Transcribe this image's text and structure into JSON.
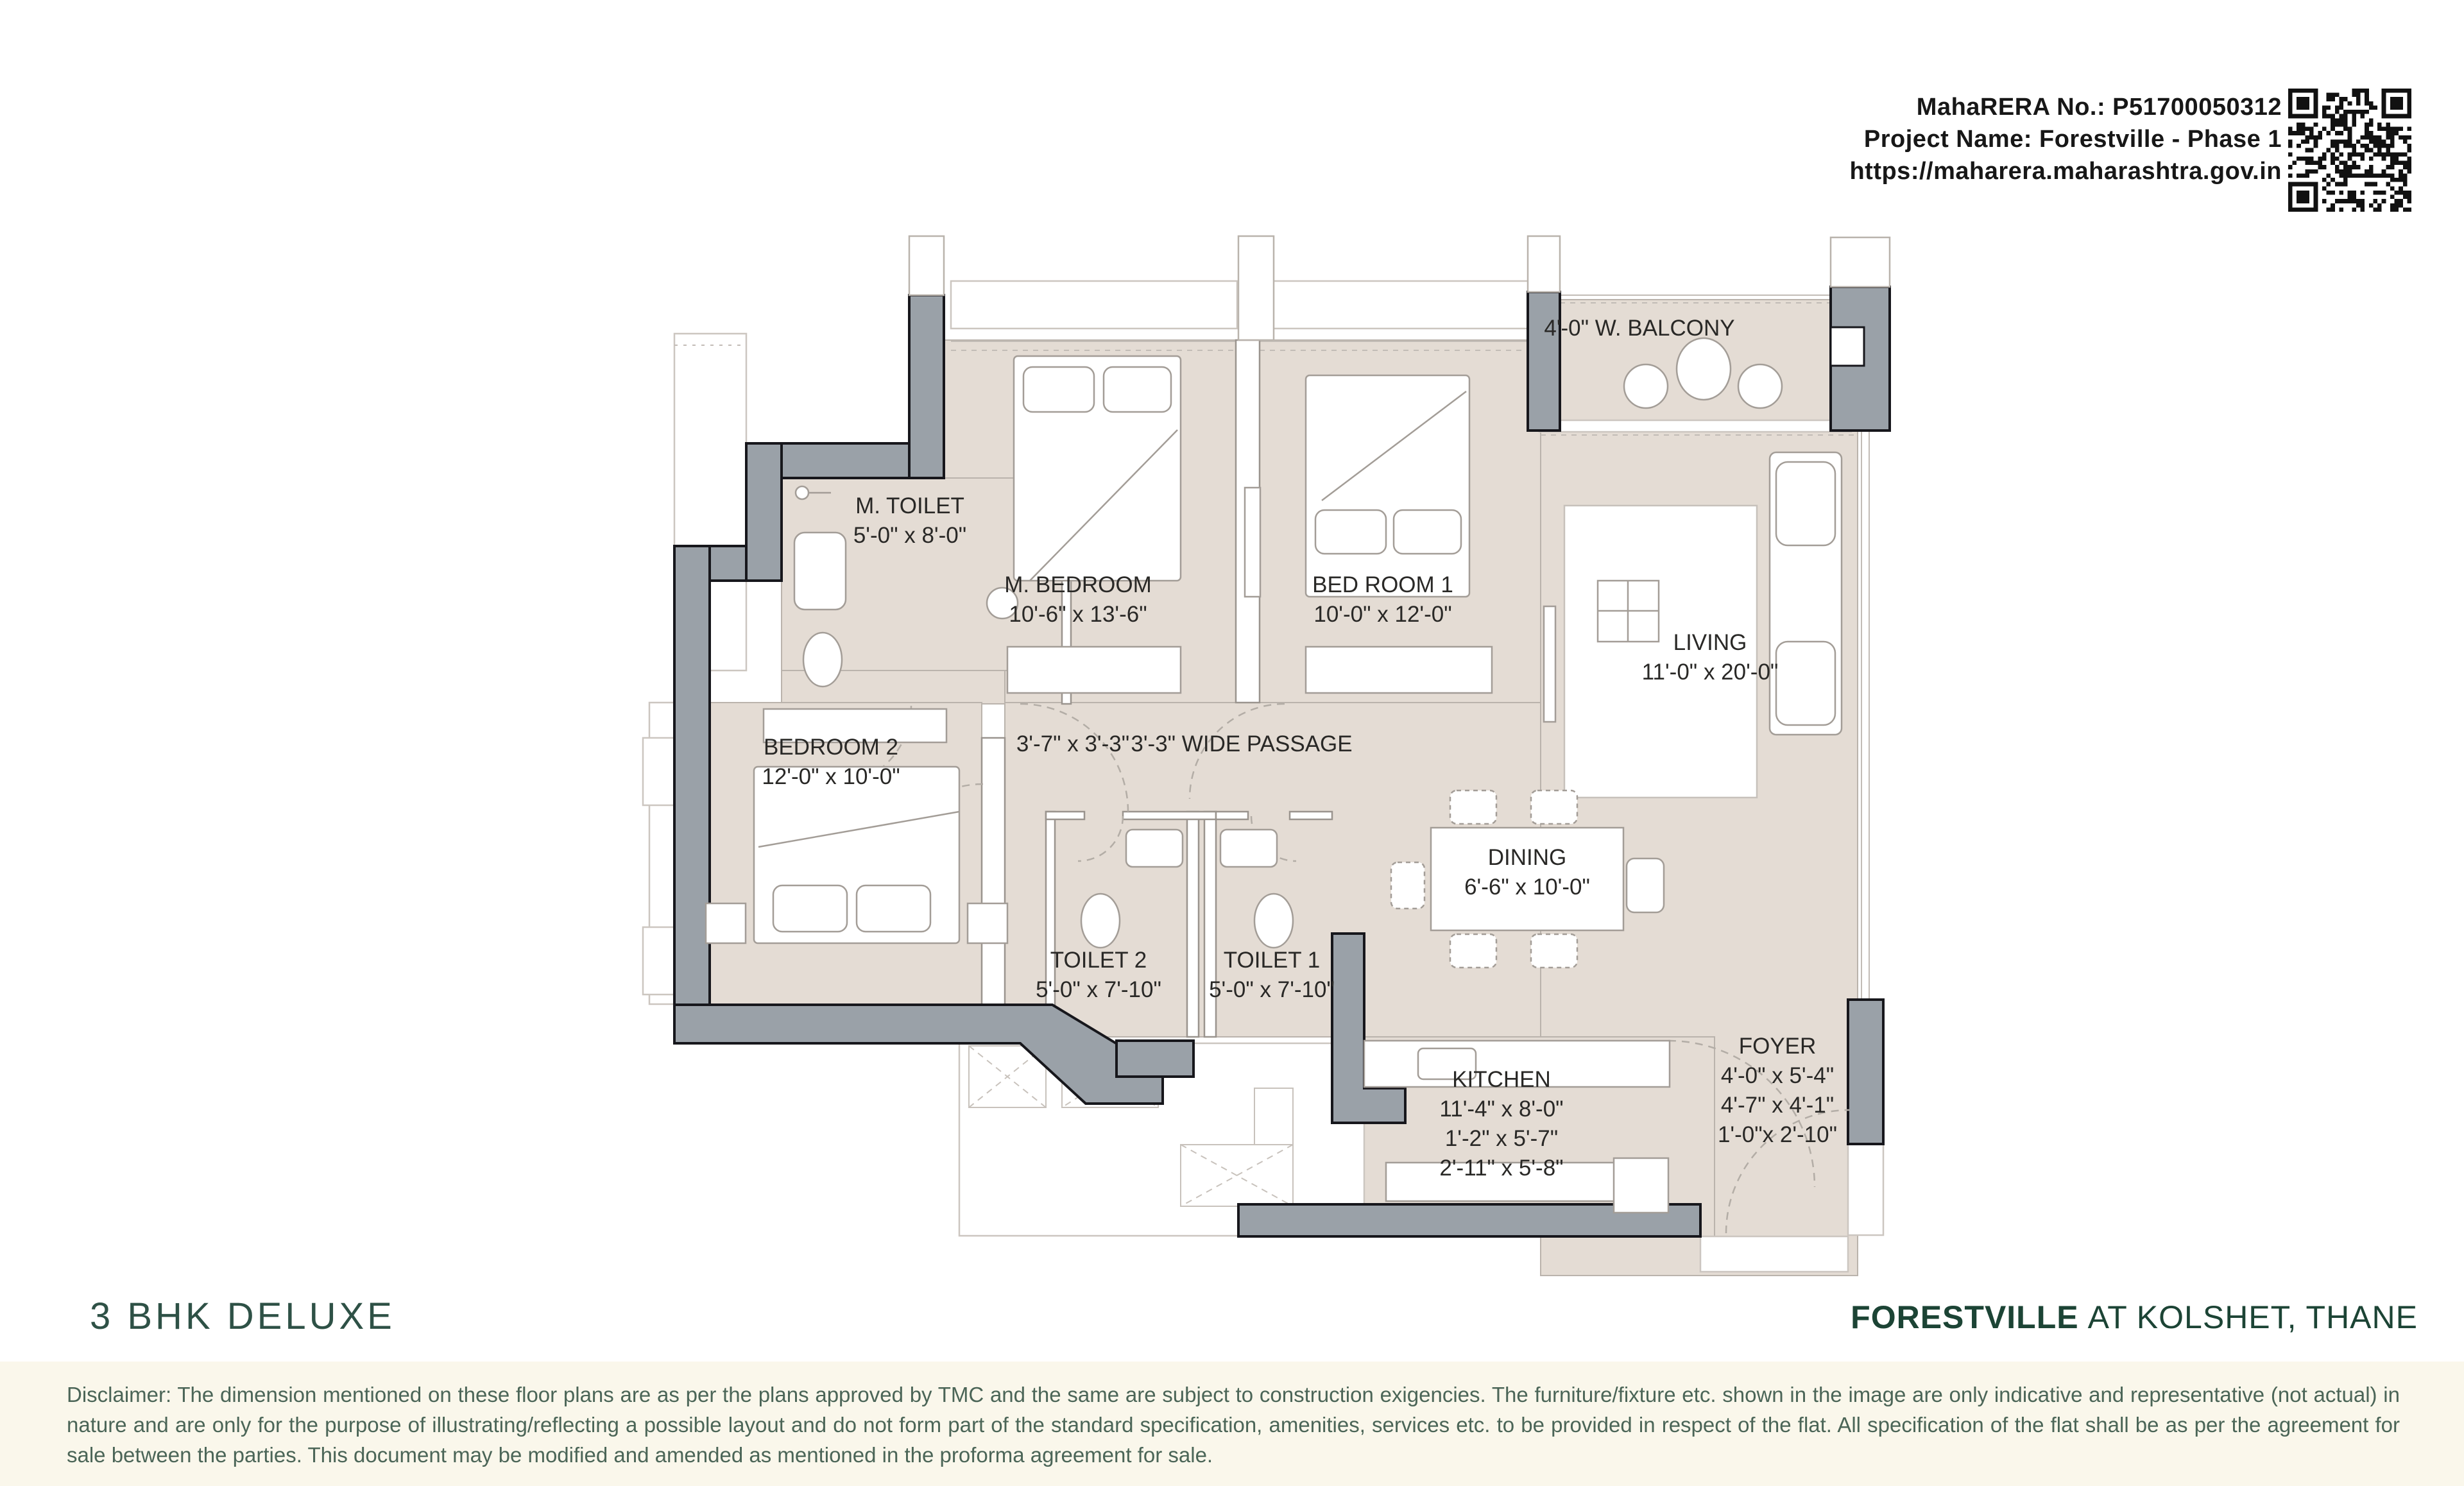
{
  "header": {
    "rera_no": "MahaRERA No.: P51700050312",
    "project_name": "Project Name: Forestville - Phase 1",
    "website": "https://maharera.maharashtra.gov.in"
  },
  "plan": {
    "balcony_label": "4'-0\" W. BALCONY",
    "lobby_dim": "3'-7\" x 3'-3\"",
    "passage_label": "3'-3\" WIDE PASSAGE",
    "rooms": {
      "m_toilet": {
        "name": "M. TOILET",
        "dims": [
          "5'-0\" x 8'-0\""
        ]
      },
      "m_bedroom": {
        "name": "M. BEDROOM",
        "dims": [
          "10'-6\" x 13'-6\""
        ]
      },
      "bedroom1": {
        "name": "BED ROOM 1",
        "dims": [
          "10'-0\" x 12'-0\""
        ]
      },
      "living": {
        "name": "LIVING",
        "dims": [
          "11'-0\" x 20'-0\""
        ]
      },
      "bedroom2": {
        "name": "BEDROOM 2",
        "dims": [
          "12'-0\" x 10'-0\""
        ]
      },
      "toilet2": {
        "name": "TOILET 2",
        "dims": [
          "5'-0\" x 7'-10\""
        ]
      },
      "toilet1": {
        "name": "TOILET 1",
        "dims": [
          "5'-0\" x 7'-10\""
        ]
      },
      "dining": {
        "name": "DINING",
        "dims": [
          "6'-6\" x 10'-0\""
        ]
      },
      "kitchen": {
        "name": "KITCHEN",
        "dims": [
          "11'-4\" x 8'-0\"",
          "1'-2\" x 5'-7\"",
          "2'-11\" x 5'-8\""
        ]
      },
      "foyer": {
        "name": "FOYER",
        "dims": [
          "4'-0\" x 5'-4\"",
          "4'-7\" x 4'-1\"",
          "1'-0\"x 2'-10\""
        ]
      }
    }
  },
  "footer": {
    "plan_type": "3 BHK DELUXE",
    "project_name": "FORESTVILLE",
    "project_location": "AT KOLSHET, THANE",
    "disclaimer": "Disclaimer: The dimension mentioned on these floor plans are as per the plans approved by TMC and the same are subject to construction exigencies. The furniture/fixture etc. shown in the image are only indicative and representative (not actual) in nature and are only for the purpose of illustrating/reflecting a possible layout and do not form part of the standard specification, amenities, services etc. to be provided in respect of the flat. All specification of the flat shall be as per the agreement for sale between the parties. This document may be modified and amended as mentioned in the proforma agreement for sale."
  },
  "colors": {
    "accent_green": "#1c4435",
    "wall_gray": "#9aa1a8",
    "floor_beige": "#e4dcd4",
    "cream_band": "#faf7eb",
    "text_dark": "#171717"
  }
}
